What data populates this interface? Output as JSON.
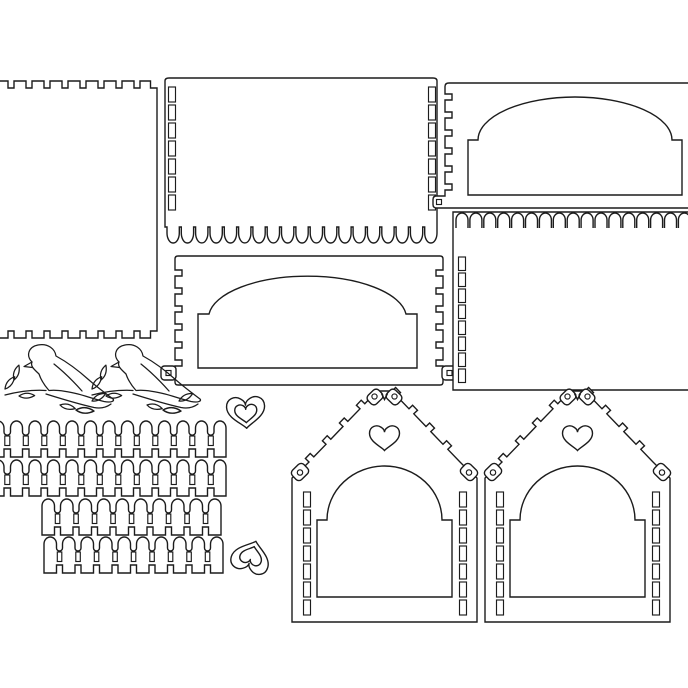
{
  "canvas": {
    "width": 688,
    "height": 688,
    "background": "#ffffff"
  },
  "style": {
    "line_color": "#1c1c1c",
    "line_width": 1.4,
    "detail_line_width": 1.15,
    "panel_fill": "#ffffff"
  },
  "template": {
    "name": "laser-cut birdhouse kit template",
    "parts": {
      "side_panel": {
        "label": "side panel with finger-joint notches",
        "top_notches": 8,
        "bottom_notches": 8
      },
      "back_panel": {
        "label": "back panel with scalloped hem",
        "slot_columns": 2,
        "slots_per_column": 7,
        "scallops": 19
      },
      "front_arch_panel": {
        "label": "front panel with arch window",
        "edge_notches_per_side": 6,
        "hanging_tabs": 2
      },
      "right_arch_panel": {
        "label": "arch window panel (cut off at right edge)",
        "edge_notches": 6,
        "hanging_tabs": 1
      },
      "fringe_panel": {
        "label": "panel with arch-fringe top edge",
        "fringe_arches": 17,
        "slots_per_column": 8
      },
      "birds": {
        "label": "bird on leafy branch silhouette",
        "count": 2
      },
      "fences": {
        "label": "picket fence strip",
        "count": 4,
        "pickets": [
          13,
          13,
          10,
          10
        ]
      },
      "heart_rings": {
        "label": "heart ring charm",
        "count": 2
      },
      "houses": {
        "label": "birdhouse front with arch door, heart cutout, zigzag roof and hanging tabs",
        "count": 2,
        "slots_per_column": 7,
        "roof_tabs_per_side": 4
      }
    }
  }
}
